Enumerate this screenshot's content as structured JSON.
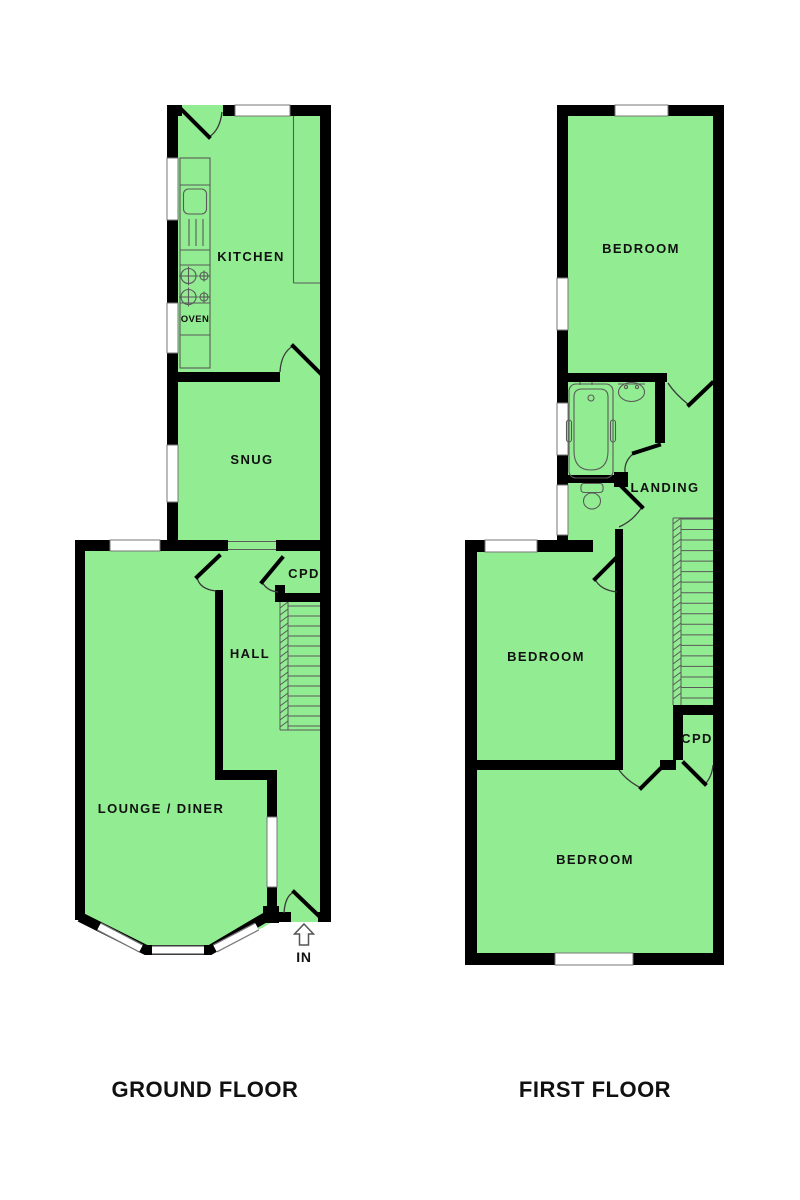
{
  "ground_floor": {
    "caption": "GROUND FLOOR",
    "kitchen": "KITCHEN",
    "oven": "OVEN",
    "snug": "SNUG",
    "cpd": "CPD",
    "hall": "HALL",
    "lounge": "LOUNGE / DINER",
    "entrance": "IN"
  },
  "first_floor": {
    "caption": "FIRST FLOOR",
    "bedroom_front": "BEDROOM",
    "landing": "LANDING",
    "bedroom_middle": "BEDROOM",
    "cpd": "CPD",
    "bedroom_back": "BEDROOM"
  },
  "colors": {
    "floor_fill": "#92ec92",
    "wall": "#000000",
    "fixture_line": "#5a5a5a",
    "window_border": "#777777",
    "label": "#111111"
  }
}
